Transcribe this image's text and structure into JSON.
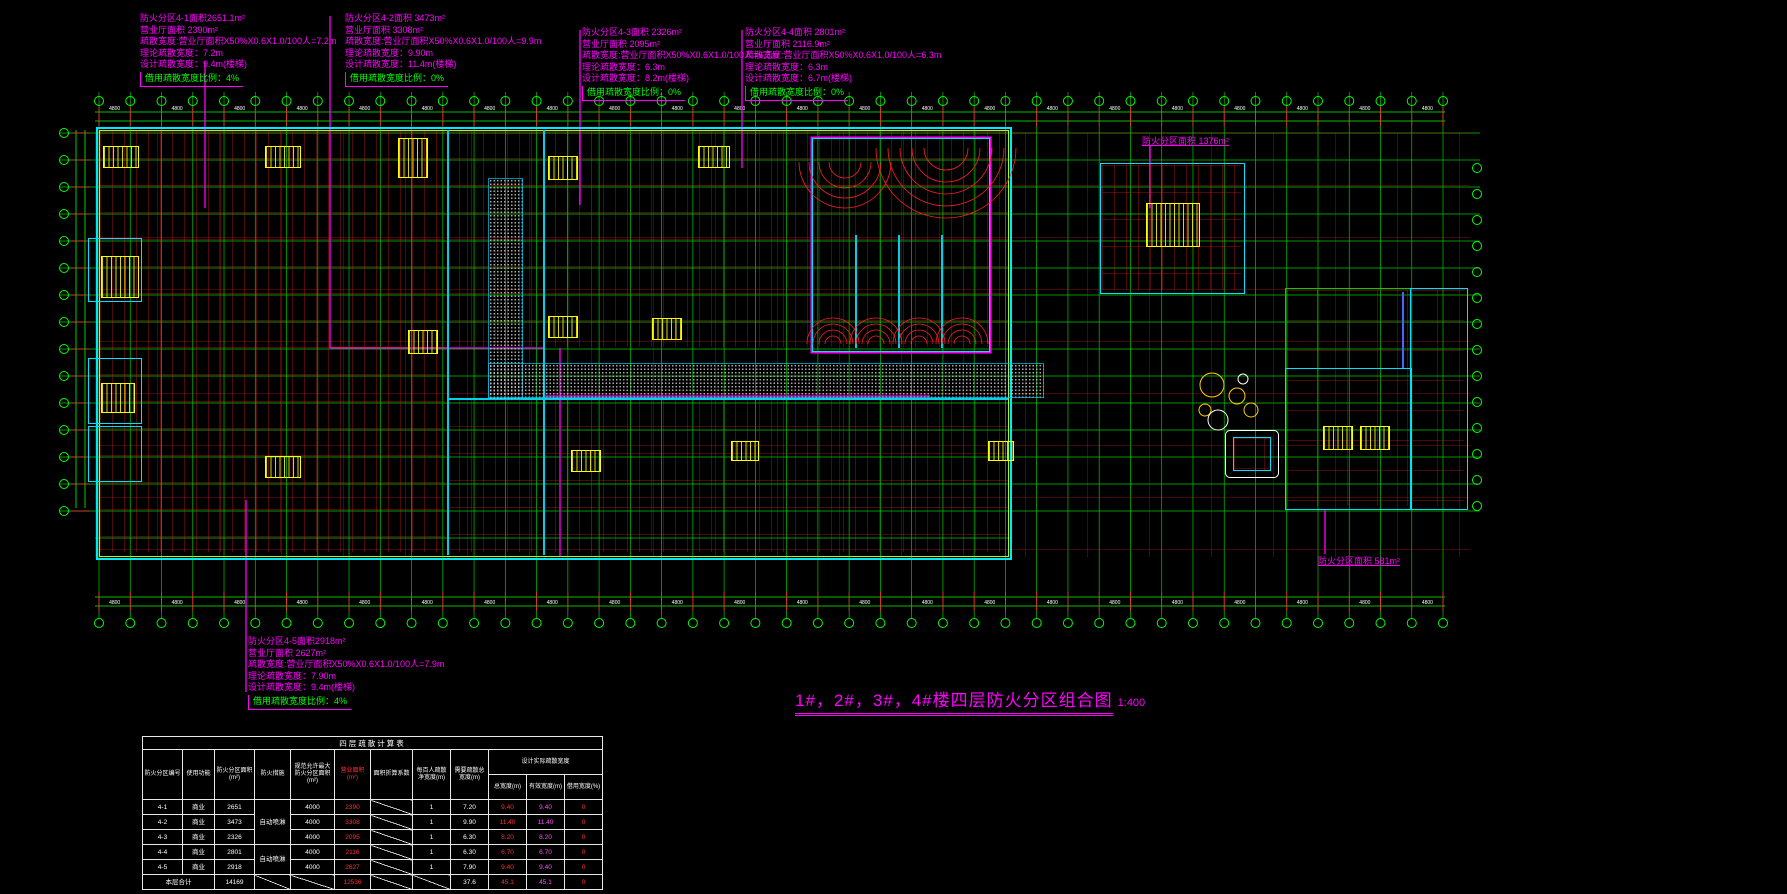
{
  "colors": {
    "background": "#000000",
    "grid_green": "#00c800",
    "grid_red": "#ff2020",
    "outline_cyan": "#00e8ff",
    "inner_chartreuse": "#9aff20",
    "zone_magenta": "#ff00ff",
    "core_yellow": "#ffff00",
    "borrow_green": "#00ff00",
    "value_red": "#ff3030",
    "value_magenta": "#ff50ff",
    "text_white": "#ffffff"
  },
  "annotations": [
    {
      "id": "zone-4-1",
      "lines": [
        "防火分区4-1面积2651.1m²",
        "营业厅面积      2390m²",
        "疏散宽度:营业厅面积X50%X0.6X1.0/100人=7.2m",
        "理论疏散宽度：7.2m",
        "设计疏散宽度：9.4m(楼梯)"
      ],
      "borrow": "借用疏散宽度比例：4%"
    },
    {
      "id": "zone-4-2",
      "lines": [
        "防火分区4-2面积 3473m²",
        "营业厅面积      3308m²",
        "疏散宽度:营业厅面积X50%X0.6X1.0/100人=9.9m",
        "理论疏散宽度：9.90m",
        "设计疏散宽度：11.4m(楼梯)"
      ],
      "borrow": "借用疏散宽度比例：0%"
    },
    {
      "id": "zone-4-3",
      "lines": [
        "防火分区4-3面积 2326m²",
        "营业厅面积      2095m²",
        "疏散宽度:营业厅面积X50%X0.6X1.0/100人=6.3m",
        "理论疏散宽度：6.3m",
        "设计疏散宽度：8.2m(楼梯)"
      ],
      "borrow": "借用疏散宽度比例：0%"
    },
    {
      "id": "zone-4-4",
      "lines": [
        "防火分区4-4面积 2801m²",
        "营业厅面积    2116.9m²",
        "疏散宽度:营业厅面积X50%X0.6X1.0/100人=6.3m",
        "理论疏散宽度：6.3m",
        "设计疏散宽度：6.7m(楼梯)"
      ],
      "borrow": "借用疏散宽度比例：0%"
    },
    {
      "id": "zone-4-5",
      "lines": [
        "防火分区4-5面积2918m²",
        "营业厅面积      2627m²",
        "疏散宽度:营业厅面积X50%X0.6X1.0/100人=7.9m",
        "理论疏散宽度：7.90m",
        "设计疏散宽度：9.4m(楼梯)"
      ],
      "borrow": "借用疏散宽度比例：4%"
    }
  ],
  "labels": {
    "tower_zone_area": "防火分区面积 1376m²",
    "right_zone_area": "防火分区面积 581m²"
  },
  "dims": {
    "bay_label": "4800"
  },
  "title": {
    "text": "1#，2#，3#，4#楼四层防火分区组合图",
    "scale": "1:400"
  },
  "table": {
    "title": "四层疏散计算表",
    "columns": [
      "防火分区编号",
      "使用功能",
      "防火分区面积(m²)",
      "防火措施",
      "规范允许最大防火分区面积(m²)",
      "营业面积(m²)",
      "面积折算系数",
      "每百人疏散净宽度(m)",
      "需要疏散总宽度(m)"
    ],
    "group": {
      "label": "设计实际疏散宽度",
      "subs": [
        "总宽度(m)",
        "有效宽度(m)",
        "借用宽度(%)"
      ]
    },
    "fire_measure": "自动喷淋",
    "rows": [
      {
        "cells": [
          "4-1",
          "商业",
          "2651",
          "自动喷淋",
          "4000",
          "2390",
          "/",
          "1",
          "7.20",
          "9.40",
          "9.40",
          "0"
        ]
      },
      {
        "cells": [
          "4-2",
          "商业",
          "3473",
          "",
          "4000",
          "3308",
          "/",
          "1",
          "9.90",
          "11.40",
          "11.40",
          "0"
        ]
      },
      {
        "cells": [
          "4-3",
          "商业",
          "2326",
          "",
          "4000",
          "2095",
          "/",
          "1",
          "6.30",
          "8.20",
          "8.20",
          "0"
        ]
      },
      {
        "cells": [
          "4-4",
          "商业",
          "2801",
          "自动喷淋",
          "4000",
          "2116",
          "/",
          "1",
          "6.30",
          "6.70",
          "6.70",
          "0"
        ]
      },
      {
        "cells": [
          "4-5",
          "商业",
          "2918",
          "",
          "4000",
          "2627",
          "/",
          "1",
          "7.90",
          "9.40",
          "9.40",
          "0"
        ]
      }
    ],
    "total": {
      "label": "本层合计",
      "cells": [
        "14169",
        "/",
        "/",
        "12536",
        "/",
        "/",
        "37.6",
        "45.1",
        "45.1",
        "0"
      ]
    }
  }
}
